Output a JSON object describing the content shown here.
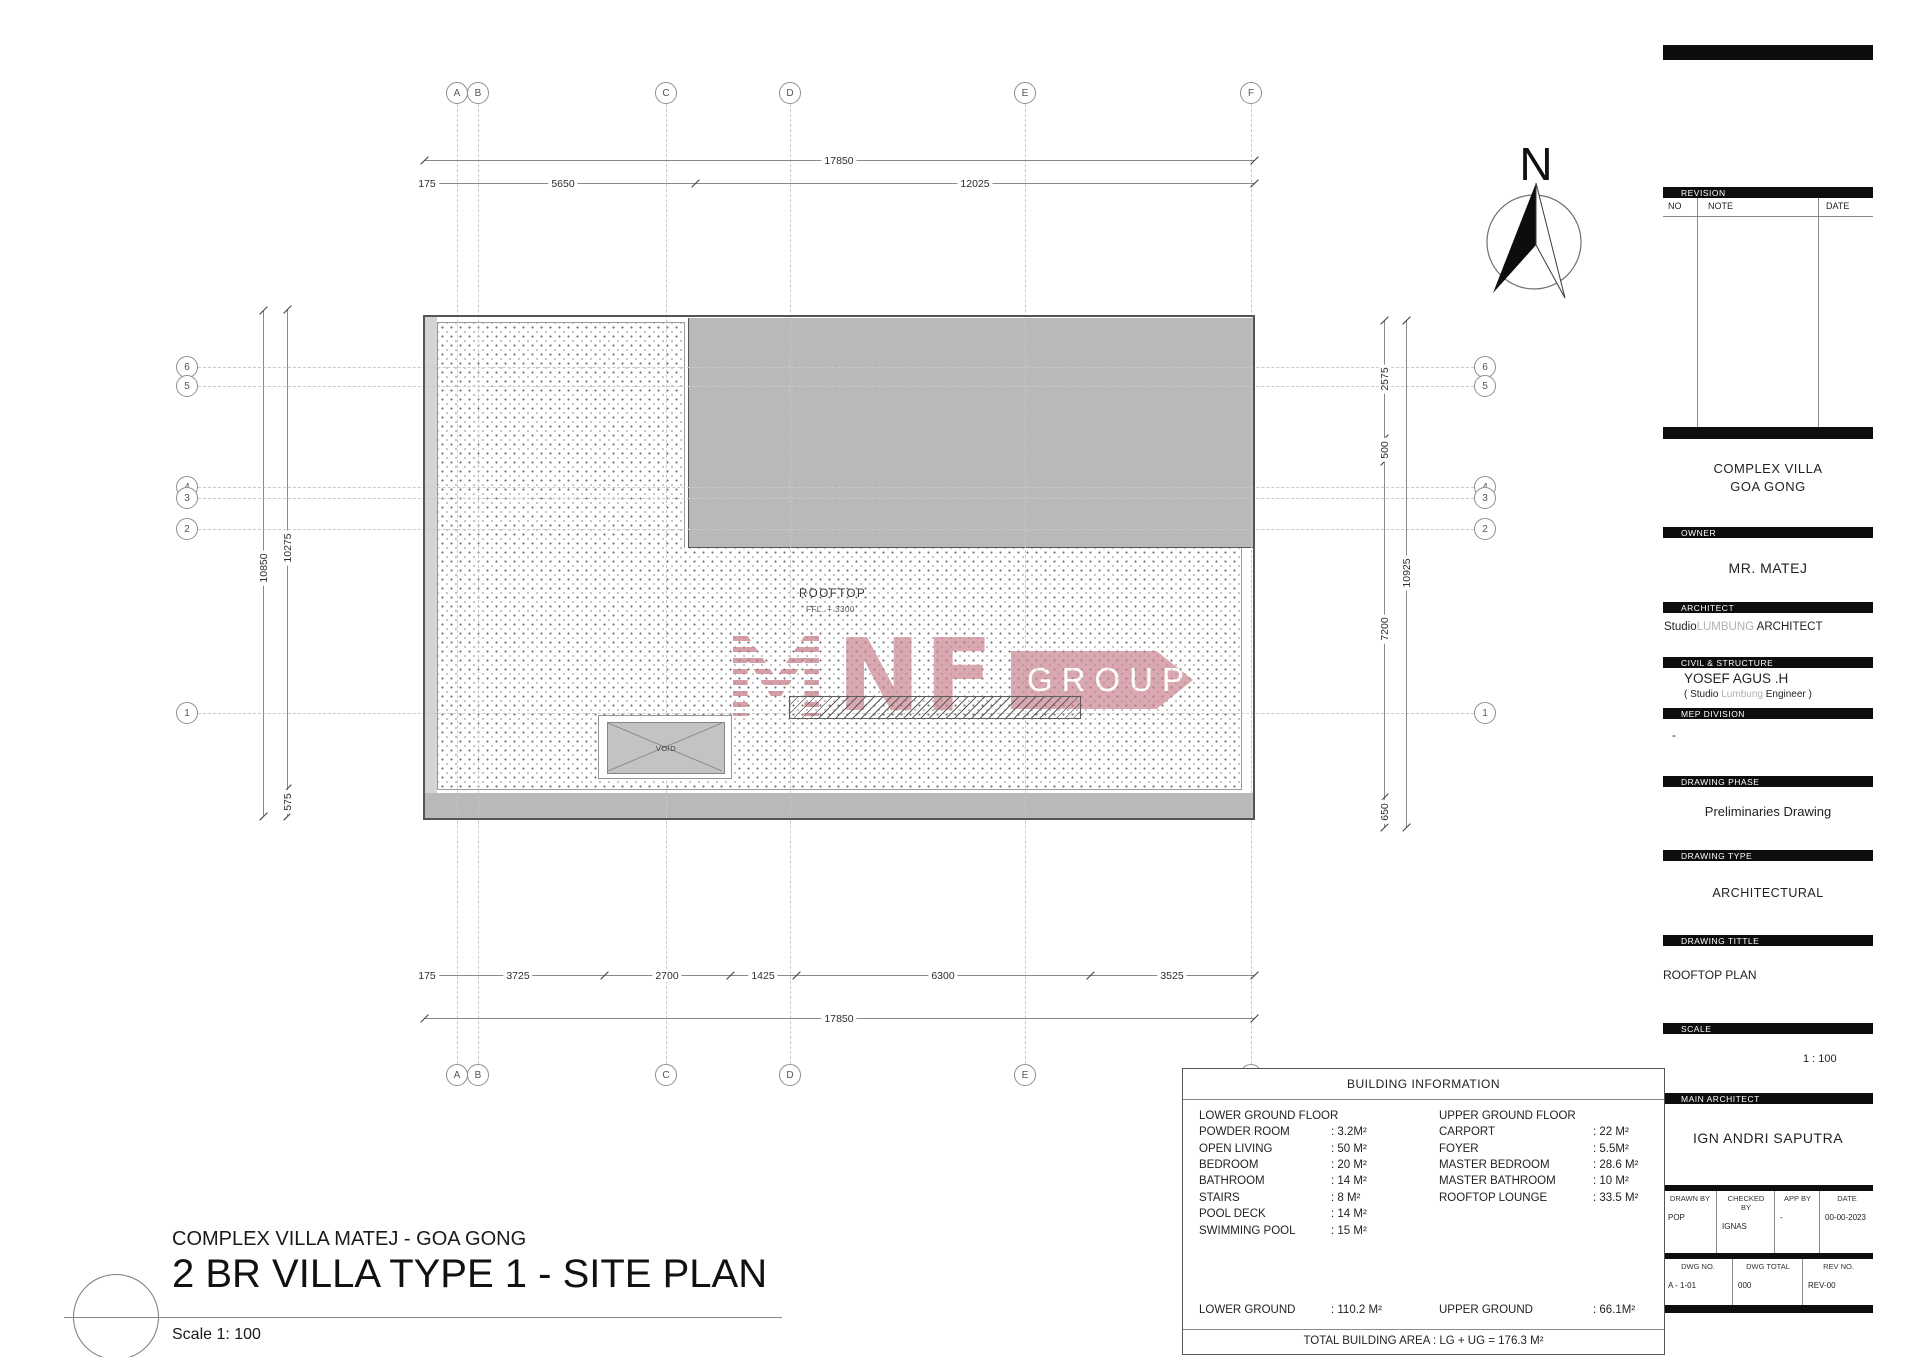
{
  "north": {
    "label": "N"
  },
  "plan": {
    "room_label": "ROOFTOP",
    "room_sublabel": "FFL. + 3300",
    "void_label": "VOID",
    "grid": {
      "cols": [
        {
          "label": "A",
          "x": 457
        },
        {
          "label": "B",
          "x": 478
        },
        {
          "label": "C",
          "x": 666
        },
        {
          "label": "D",
          "x": 790
        },
        {
          "label": "E",
          "x": 1025
        },
        {
          "label": "F",
          "x": 1251
        }
      ],
      "rows": [
        {
          "label": "6",
          "y": 367
        },
        {
          "label": "5",
          "y": 386
        },
        {
          "label": "4",
          "y": 487
        },
        {
          "label": "3",
          "y": 498
        },
        {
          "label": "2",
          "y": 529
        },
        {
          "label": "1",
          "y": 713
        }
      ],
      "col_bubble_y_top": 93,
      "col_bubble_y_bottom": 1075,
      "row_bubble_x_left": 187,
      "row_bubble_x_right": 1485
    },
    "dimensions": {
      "horizontal": [
        {
          "y": 160,
          "ticks": [
            424,
            1254
          ],
          "labels": [
            {
              "text": "17850",
              "x": 839
            }
          ]
        },
        {
          "y": 183,
          "ticks": [
            424,
            432,
            695,
            1254
          ],
          "labels": [
            {
              "text": "175",
              "x": 427
            },
            {
              "text": "5650",
              "x": 563
            },
            {
              "text": "12025",
              "x": 975
            }
          ]
        },
        {
          "y": 975,
          "ticks": [
            424,
            432,
            604,
            730,
            796,
            1090,
            1254
          ],
          "labels": [
            {
              "text": "175",
              "x": 427
            },
            {
              "text": "3725",
              "x": 518
            },
            {
              "text": "2700",
              "x": 667
            },
            {
              "text": "1425",
              "x": 763
            },
            {
              "text": "6300",
              "x": 943
            },
            {
              "text": "3525",
              "x": 1172
            }
          ]
        },
        {
          "y": 1018,
          "ticks": [
            424,
            1254
          ],
          "labels": [
            {
              "text": "17850",
              "x": 839
            }
          ]
        }
      ],
      "vertical": [
        {
          "x": 263,
          "ticks": [
            310,
            816
          ],
          "labels": [
            {
              "text": "10850",
              "y": 568
            }
          ]
        },
        {
          "x": 287,
          "ticks": [
            309,
            788,
            816
          ],
          "labels": [
            {
              "text": "10275",
              "y": 548
            },
            {
              "text": "575",
              "y": 802
            }
          ]
        },
        {
          "x": 1384,
          "ticks": [
            320,
            438,
            461,
            797,
            827
          ],
          "labels": [
            {
              "text": "2575",
              "y": 379
            },
            {
              "text": "500",
              "y": 450
            },
            {
              "text": "7200",
              "y": 629
            },
            {
              "text": "650",
              "y": 812
            }
          ]
        },
        {
          "x": 1406,
          "ticks": [
            320,
            827
          ],
          "labels": [
            {
              "text": "10925",
              "y": 573
            }
          ]
        }
      ]
    }
  },
  "watermark": {
    "letters_striped": "M",
    "letters": "NF",
    "group": "GROUP",
    "color": "#c9808c"
  },
  "titleblock": {
    "revision": {
      "header": "REVISION",
      "cols": [
        "NO",
        "NOTE",
        "DATE"
      ]
    },
    "project_line1": "COMPLEX VILLA",
    "project_line2": "GOA GONG",
    "owner": {
      "header": "OWNER",
      "name": "MR. MATEJ"
    },
    "architect": {
      "header": "ARCHITECT",
      "studio": "Studio",
      "studio_accent": "LUMBUNG",
      "suffix": " ARCHITECT"
    },
    "civil": {
      "header": "CIVIL & STRUCTURE",
      "name": "YOSEF AGUS .H",
      "sub_prefix": "( Studio ",
      "sub_accent": "Lumbung",
      "sub_suffix": " Engineer )"
    },
    "mep": {
      "header": "MEP DIVISION",
      "value": "-"
    },
    "phase": {
      "header": "DRAWING PHASE",
      "value": "Preliminaries Drawing"
    },
    "type": {
      "header": "DRAWING TYPE",
      "value": "ARCHITECTURAL"
    },
    "title": {
      "header": "DRAWING TITTLE",
      "value": "ROOFTOP PLAN"
    },
    "scale": {
      "header": "SCALE",
      "value": "1 : 100"
    },
    "main_architect": {
      "header": "MAIN ARCHITECT",
      "name": "IGN ANDRI SAPUTRA"
    },
    "meta1": [
      {
        "label": "DRAWN BY",
        "value": "POP",
        "w": 54
      },
      {
        "label": "CHECKED BY",
        "value": "IGNAS",
        "w": 58
      },
      {
        "label": "APP BY",
        "value": "-",
        "w": 45
      },
      {
        "label": "DATE",
        "value": "00-00-2023",
        "w": 53
      }
    ],
    "meta2": [
      {
        "label": "DWG NO.",
        "value": "A - 1-01",
        "w": 70
      },
      {
        "label": "DWG TOTAL",
        "value": "000",
        "w": 70
      },
      {
        "label": "REV NO.",
        "value": "REV-00",
        "w": 70
      }
    ]
  },
  "building_info": {
    "title": "BUILDING INFORMATION",
    "left": {
      "heading": "LOWER GROUND FLOOR",
      "rows": [
        {
          "label": "POWDER ROOM",
          "value": "3.2M²"
        },
        {
          "label": "OPEN LIVING",
          "value": "50 M²"
        },
        {
          "label": "BEDROOM",
          "value": "20 M²"
        },
        {
          "label": "BATHROOM",
          "value": "14 M²"
        },
        {
          "label": "STAIRS",
          "value": "8  M²"
        },
        {
          "label": "POOL DECK",
          "value": "14 M²"
        },
        {
          "label": "SWIMMING POOL",
          "value": "15 M²"
        }
      ]
    },
    "right": {
      "heading": "UPPER GROUND FLOOR",
      "rows": [
        {
          "label": "CARPORT",
          "value": "22 M²"
        },
        {
          "label": "FOYER",
          "value": "5.5M²"
        },
        {
          "label": "MASTER BEDROOM",
          "value": "28.6 M²"
        },
        {
          "label": "MASTER BATHROOM",
          "value": "10  M²"
        },
        {
          "label": "ROOFTOP LOUNGE",
          "value": "33.5 M²"
        }
      ]
    },
    "totals": {
      "left_label": "LOWER GROUND",
      "left_value": "110.2 M²",
      "right_label": "UPPER GROUND",
      "right_value": "66.1M²"
    },
    "total_area": "TOTAL BUILDING AREA : LG + UG = 176.3 M²"
  },
  "sheet_title": {
    "project": "COMPLEX VILLA MATEJ - GOA GONG",
    "title": "2 BR VILLA TYPE 1 - SITE PLAN",
    "scale": "Scale 1: 100"
  }
}
